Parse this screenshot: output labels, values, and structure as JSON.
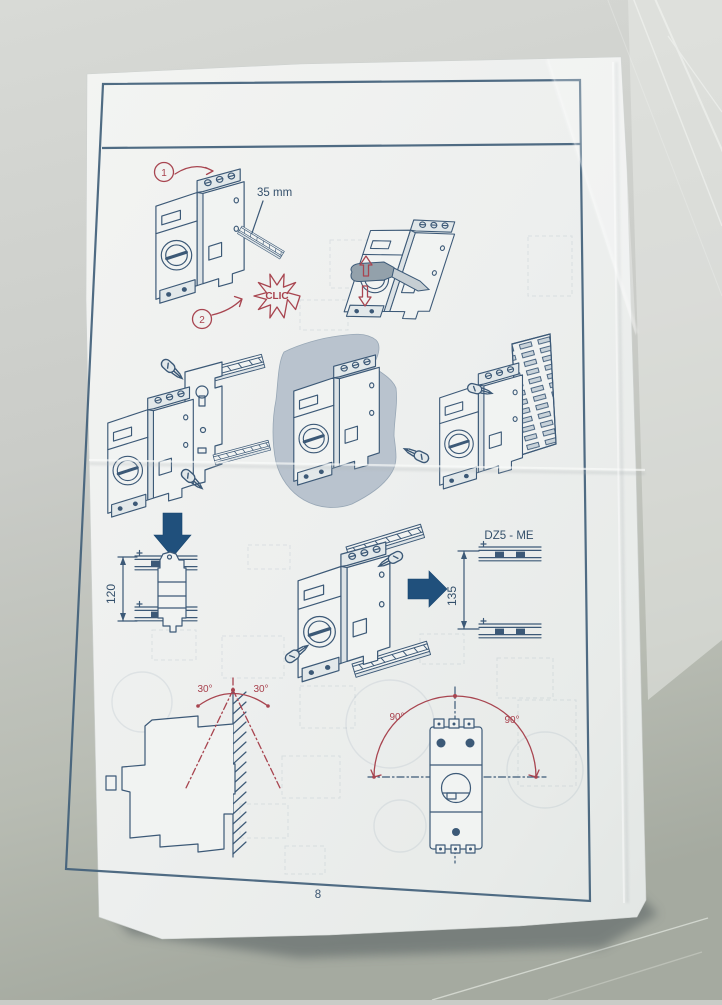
{
  "document": {
    "kind": "installation-instruction-page",
    "page_number": "8"
  },
  "figures": {
    "din_mount": {
      "step_1": "1",
      "step_2": "2",
      "rail_width": "35 mm",
      "click": "CLIC"
    },
    "dimensions": {
      "height": "120",
      "rail_spacing": "135",
      "rail_model": "DZ5 - ME"
    },
    "tilt": {
      "left": "30°",
      "right": "30°"
    },
    "rotation": {
      "left": "90°",
      "right": "90°"
    }
  },
  "icons": {
    "down-arrow": "solid blue down arrow",
    "right-arrow": "solid blue right arrow",
    "clic-burst": "red starburst",
    "screwdriver": "flat screwdriver",
    "up-arrow-outline": "red outline up arrow",
    "down-arrow-outline": "red outline down arrow"
  },
  "colors": {
    "ink": "#3c5977",
    "frame": "#41607a",
    "red": "#a84550",
    "arrow_blue": "#20507c",
    "paper": "#eff1ef",
    "desk": "#c9ccc7"
  }
}
